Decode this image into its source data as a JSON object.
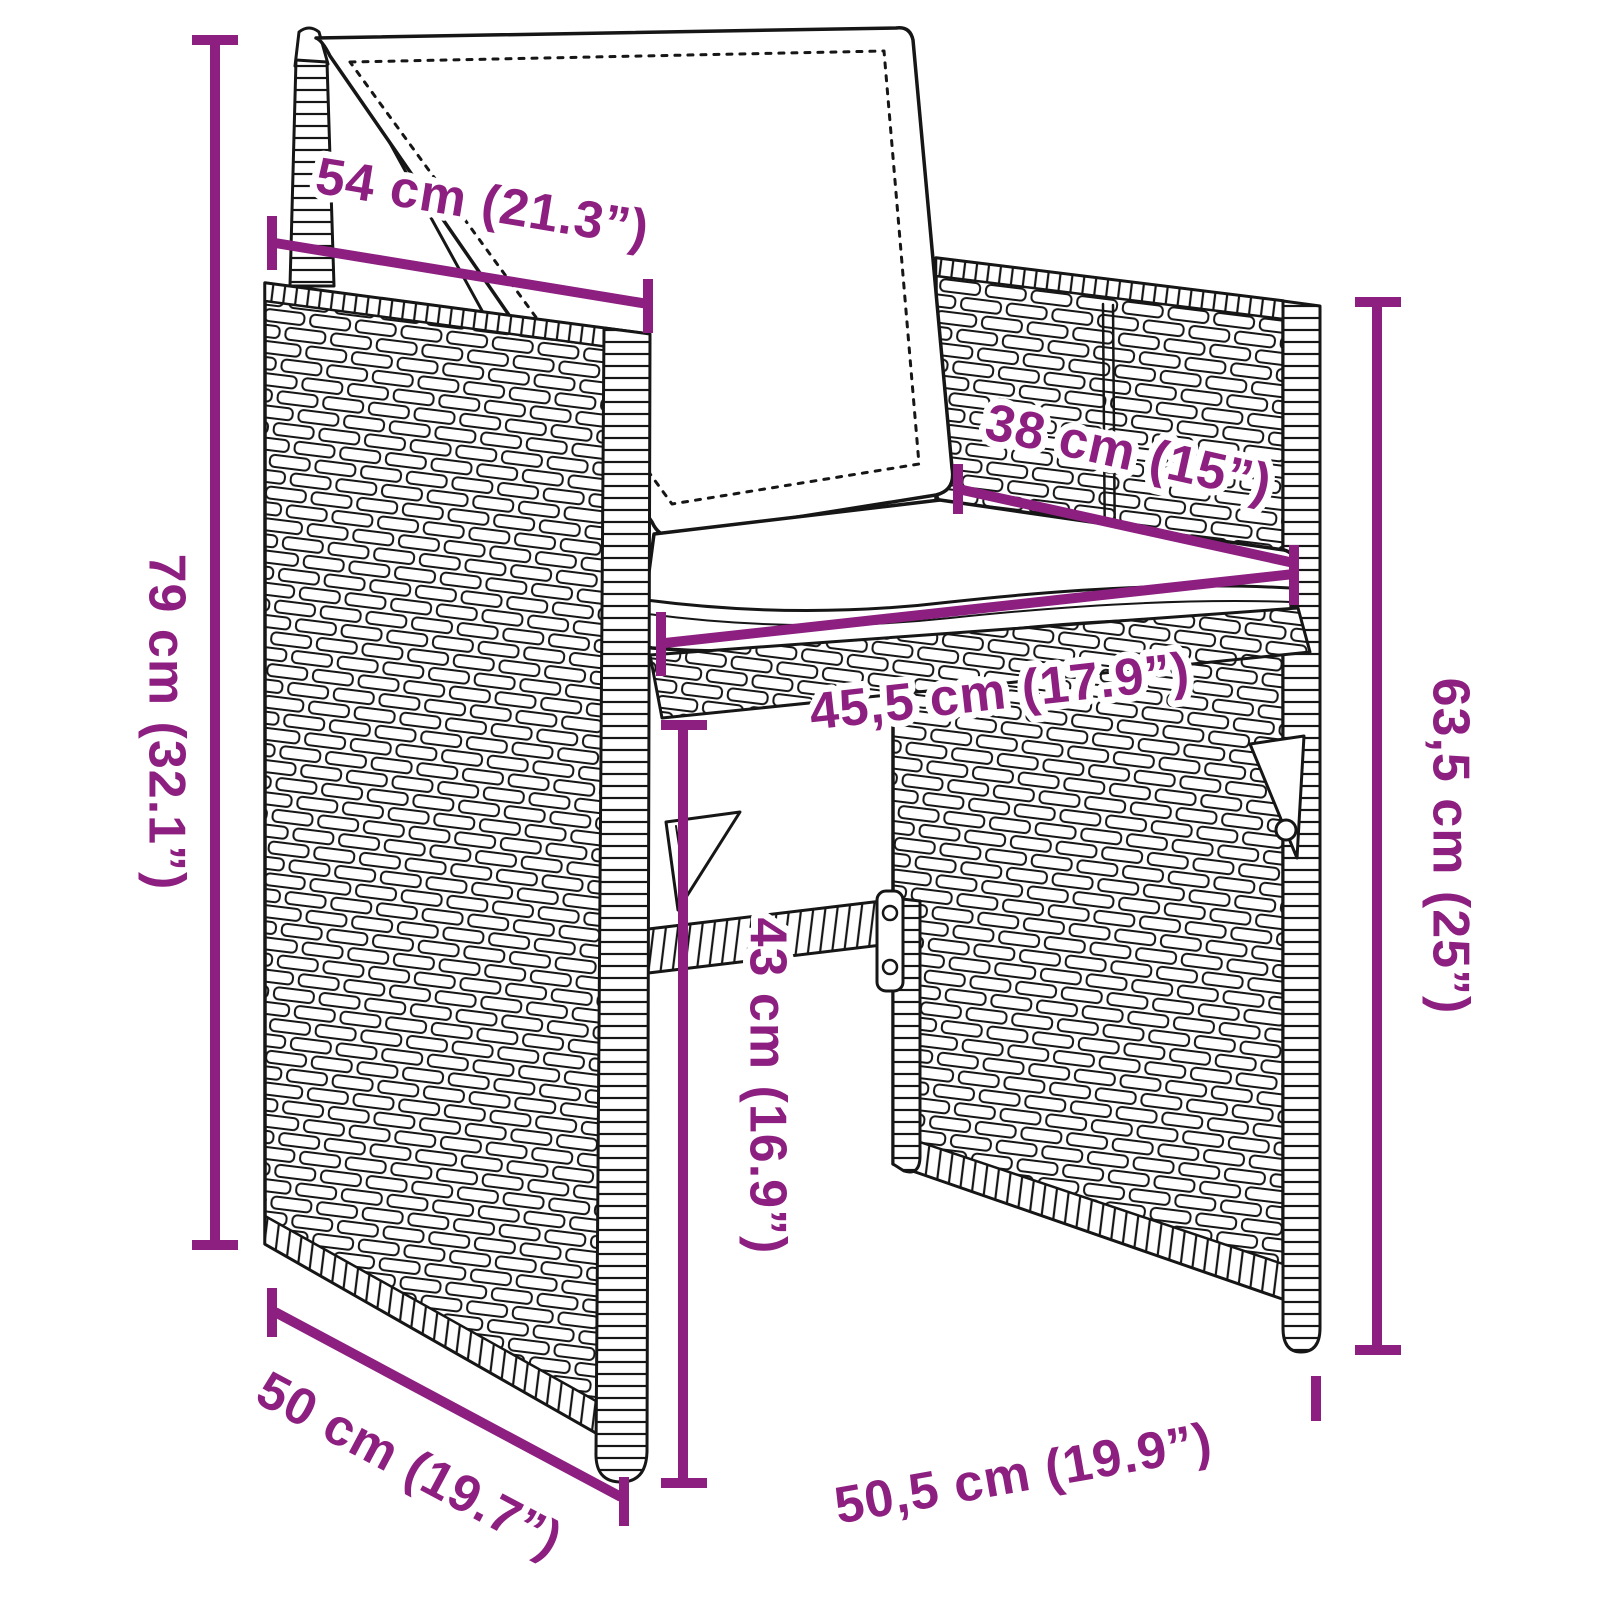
{
  "figure": {
    "kind": "product dimension diagram",
    "subject": "poly rattan garden chair with cushions",
    "style": "black line-art with purple dimension annotations"
  },
  "colors": {
    "dimension_accent": "#8C1F7F",
    "line_art": "#161616",
    "background": "#FFFFFF"
  },
  "dimensions": {
    "backrest_width": {
      "label": "54 cm (21.3”)",
      "value_cm": 54,
      "value_in": 21.3
    },
    "seat_depth": {
      "label": "38 cm (15”)",
      "value_cm": 38,
      "value_in": 15
    },
    "seat_width": {
      "label": "45,5 cm (17.9”)",
      "value_cm": 45.5,
      "value_in": 17.9
    },
    "total_height": {
      "label": "79 cm (32.1”)",
      "value_cm": 79,
      "value_in": 32.1
    },
    "armrest_height": {
      "label": "63,5 cm (25”)",
      "value_cm": 63.5,
      "value_in": 25
    },
    "seat_height": {
      "label": "43 cm (16.9”)",
      "value_cm": 43,
      "value_in": 16.9
    },
    "side_depth": {
      "label": "50 cm (19.7”)",
      "value_cm": 50,
      "value_in": 19.7
    },
    "base_width": {
      "label": "50,5 cm (19.9”)",
      "value_cm": 50.5,
      "value_in": 19.9
    }
  }
}
